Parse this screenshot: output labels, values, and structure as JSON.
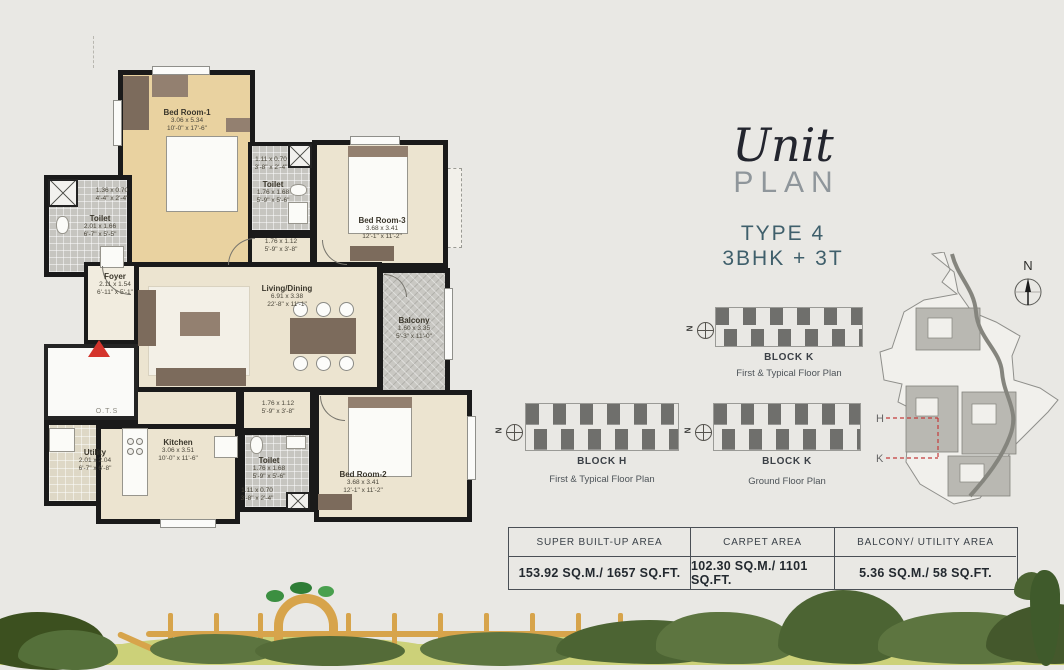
{
  "title": {
    "script": "Unit",
    "caps": "PLAN",
    "type_line1": "TYPE 4",
    "type_line2": "3BHK + 3T"
  },
  "compass_letter": "N",
  "floorplan": {
    "rooms": {
      "bedroom1": {
        "name": "Bed Room-1",
        "m": "3.06 x 5.34",
        "ft": "10'-0\" x 17'-6\""
      },
      "toilet_left": {
        "name": "Toilet",
        "m": "2.01 x 1.66",
        "ft": "6'-7\" x 5'-5\""
      },
      "pass_left": {
        "m": "1.36 x 0.70",
        "ft": "4'-4\" x 2'-4\""
      },
      "pass_top": {
        "m": "1.11 x 0.70",
        "ft": "3'-8\" x 2'-4\""
      },
      "toilet_mid": {
        "name": "Toilet",
        "m": "1.76 x 1.68",
        "ft": "5'-9\" x 5'-6\""
      },
      "bedroom3": {
        "name": "Bed Room-3",
        "m": "3.68 x 3.41",
        "ft": "12'-1\" x 11'-2\""
      },
      "pass_mid": {
        "m": "1.76 x 1.12",
        "ft": "5'-9\" x 3'-8\""
      },
      "foyer": {
        "name": "Foyer",
        "m": "2.11 x 1.54",
        "ft": "6'-11\" x 5'-1\""
      },
      "living": {
        "name": "Living/Dining",
        "m": "6.91 x 3.38",
        "ft": "22'-8\" x 11'-1\""
      },
      "balcony": {
        "name": "Balcony",
        "m": "1.60 x 3.35",
        "ft": "5'-3\" x 11'-0\""
      },
      "pass_bottom": {
        "m": "1.76 x 1.12",
        "ft": "5'-9\" x 3'-8\""
      },
      "kitchen": {
        "name": "Kitchen",
        "m": "3.06 x 3.51",
        "ft": "10'-0\" x 11'-6\""
      },
      "utility": {
        "name": "Utility",
        "m": "2.01 x 2.04",
        "ft": "6'-7\" x 6'-8\""
      },
      "toilet_bottom": {
        "name": "Toilet",
        "m": "1.76 x 1.68",
        "ft": "5'-9\" x 5'-6\""
      },
      "pass_bot": {
        "m": "1.11 x 0.70",
        "ft": "3'-8\" x 2'-4\""
      },
      "bedroom2": {
        "name": "Bed Room-2",
        "m": "3.68 x 3.41",
        "ft": "12'-1\" x 11'-2\""
      },
      "ots": {
        "name": "O.T.S"
      }
    }
  },
  "keyplans": [
    {
      "block": "BLOCK K",
      "caption": "First & Typical Floor Plan"
    },
    {
      "block": "BLOCK H",
      "caption": "First & Typical Floor Plan"
    },
    {
      "block": "BLOCK K",
      "caption": "Ground Floor Plan"
    }
  ],
  "sitemap": {
    "label_h": "H",
    "label_k": "K"
  },
  "area_table": {
    "headers": [
      "SUPER BUILT-UP AREA",
      "CARPET AREA",
      "BALCONY/ UTILITY AREA"
    ],
    "values": [
      "153.92 SQ.M./ 1657 SQ.FT.",
      "102.30 SQ.M./ 1101 SQ.FT.",
      "5.36 SQ.M./ 58 SQ.FT."
    ]
  },
  "colors": {
    "accent_teal": "#3f5f6b",
    "entry_red": "#d4342c",
    "wall_black": "#1a1a1a",
    "fence_tan": "#d7a44b",
    "grass_green": "#ccd179",
    "bush_dark": "#44582c",
    "bush_mid": "#5d7540"
  }
}
